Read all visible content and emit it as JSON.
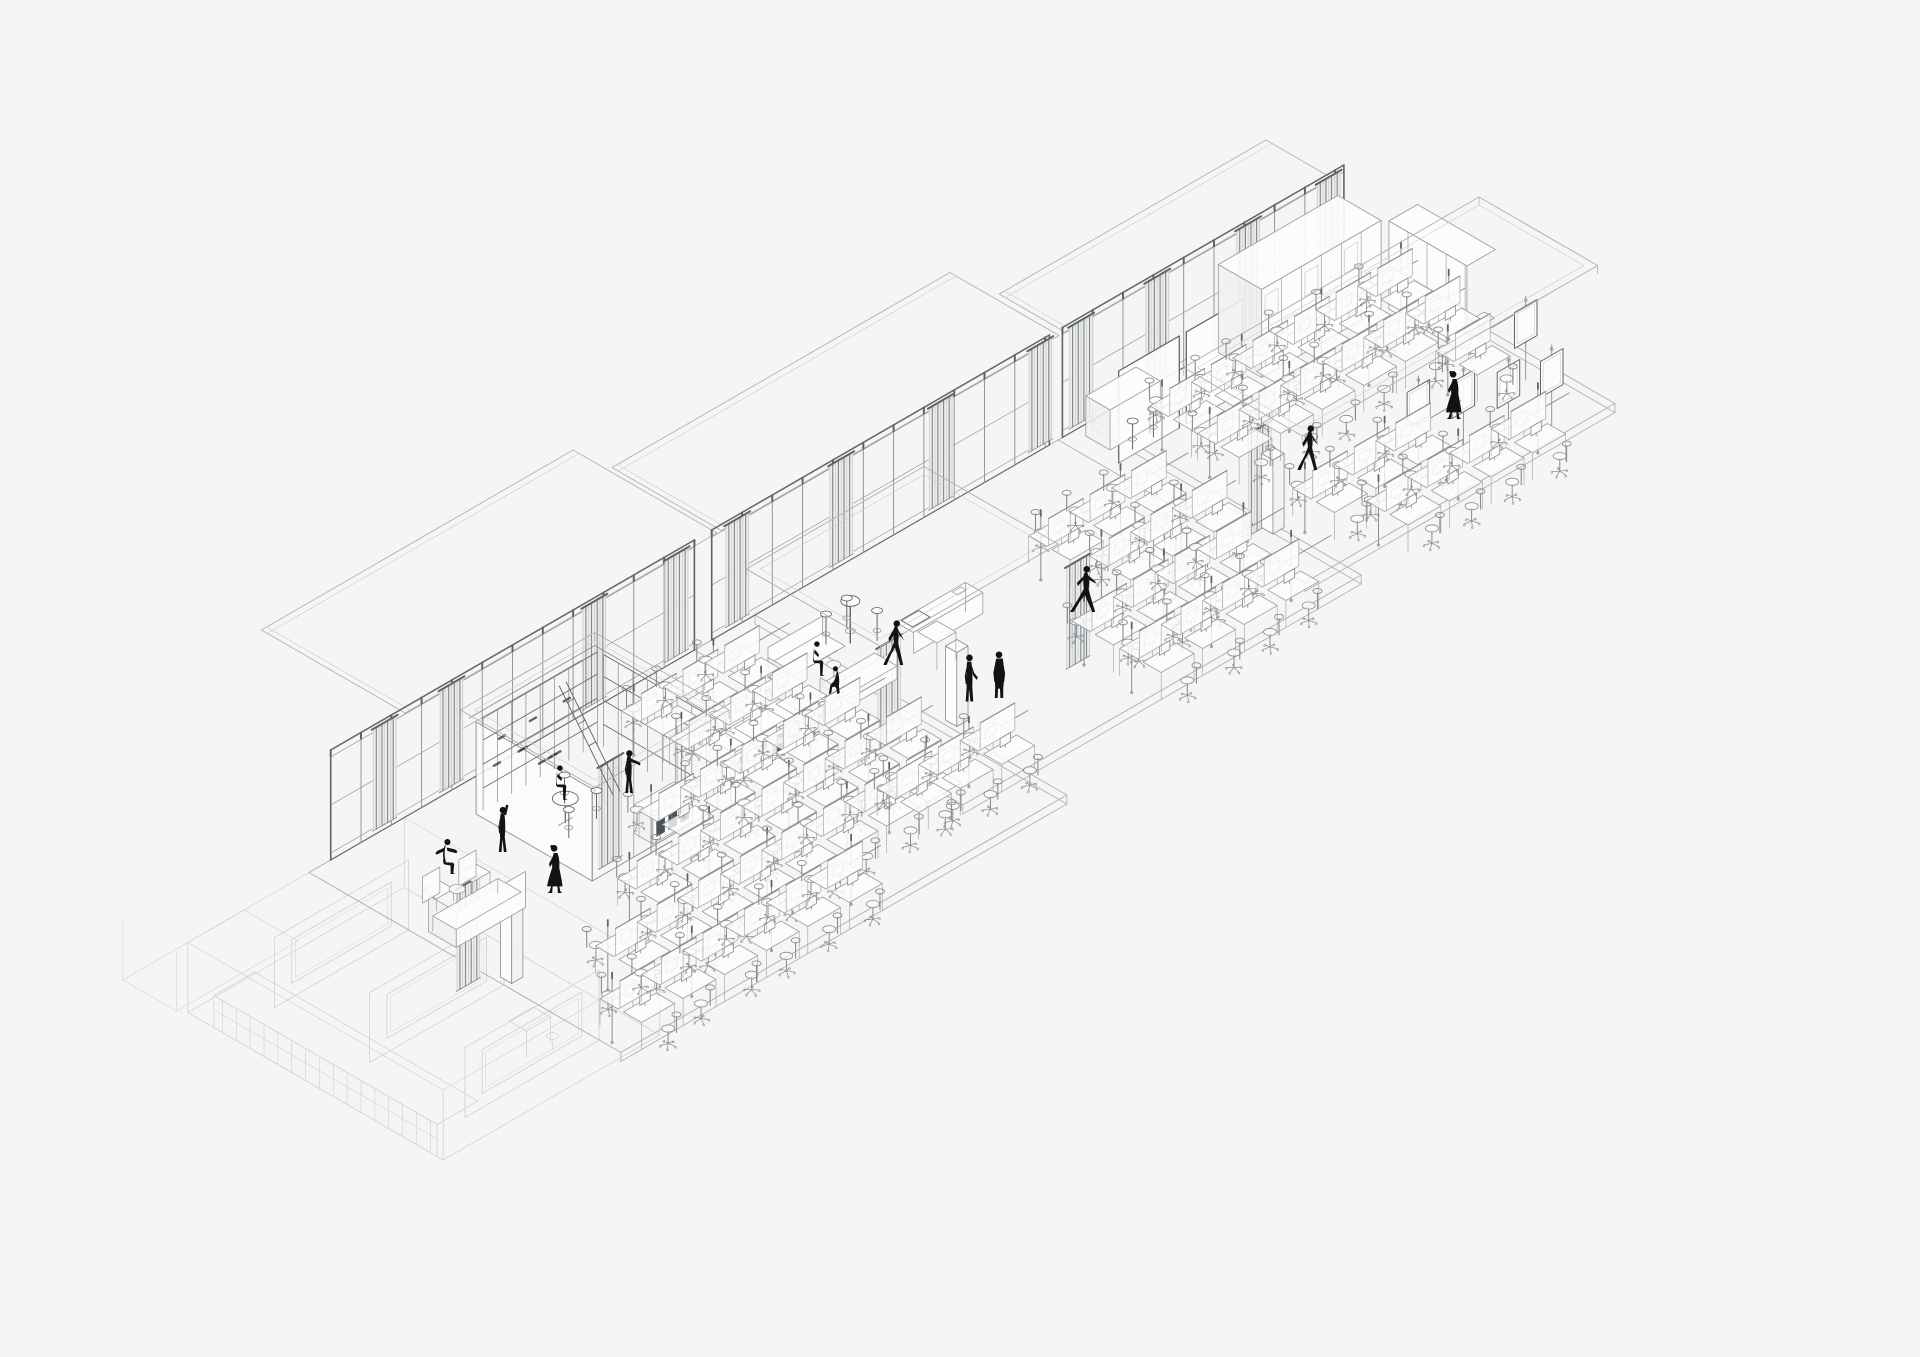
{
  "meta": {
    "drawing": "isometric-office-floor-axonometric",
    "canvas": {
      "width": 1920,
      "height": 1357
    },
    "background": "#f5f5f4"
  },
  "palette": {
    "ink": "#121316",
    "wall": "#5f6468",
    "mullion": "#888d91",
    "light": "#aeb3b6",
    "lighter": "#c7cbce",
    "furn": "#9aa0a4",
    "chair": "#868c90",
    "fill_white": "#fcfcfb",
    "fill_soft": "#f1f1f0",
    "slot_dark": "#3c4145",
    "curtain_dark": "#82888c",
    "curtain_light": "#c3c7ca",
    "curtain_bg": "#ebebea"
  },
  "iso": {
    "origin_x": 322,
    "origin_y": 865,
    "cos": 0.866,
    "sin": 0.5,
    "wall_height": 110
  },
  "floors": [
    {
      "u0": -15,
      "u1": 500,
      "v1": 360
    },
    {
      "u0": 430,
      "u1": 890,
      "v1": 310
    },
    {
      "u0": 850,
      "u1": 1208,
      "v1": 285
    }
  ],
  "walls": [
    {
      "u0": 10,
      "u1": 430,
      "curtains": [
        58,
        135,
        300,
        395
      ]
    },
    {
      "u0": 450,
      "u1": 840,
      "curtains": [
        465,
        585,
        700,
        815
      ]
    },
    {
      "u0": 855,
      "u1": 1180,
      "curtains": [
        862,
        950,
        1055,
        1148
      ]
    }
  ],
  "eaves": [
    {
      "u0": 90,
      "u1": 450,
      "vdepth": -160
    },
    {
      "u0": 455,
      "u1": 845,
      "vdepth": -120
    },
    {
      "u0": 852,
      "u1": 1160,
      "vdepth": -70
    }
  ],
  "roof_plates": [
    {
      "u0": 135,
      "u1": 290,
      "v0": 25,
      "v1": 180,
      "h": 100
    },
    {
      "u0": 435,
      "u1": 640,
      "v0": 55,
      "v1": 210,
      "h": 106
    },
    {
      "u0": 887,
      "u1": 1228,
      "v0": 108,
      "v1": 245,
      "h": 108
    }
  ],
  "columns": [
    {
      "u": -9,
      "v": 215
    },
    {
      "u": 505,
      "v": 215
    },
    {
      "u": 748,
      "v": 212
    },
    {
      "u": 880,
      "v": 205
    }
  ],
  "interior_curtains": [
    {
      "u": -54,
      "v": 210
    },
    {
      "u": 150,
      "v": 170
    },
    {
      "u": 430,
      "v": 212
    },
    {
      "u": 620,
      "v": 240
    },
    {
      "u": 858,
      "v": 212
    }
  ],
  "desk_rails": [
    {
      "v": 70,
      "u0": 290,
      "u1": 470
    },
    {
      "v": 125,
      "u0": 290,
      "u1": 470
    },
    {
      "v": 180,
      "u0": 200,
      "u1": 470
    },
    {
      "v": 235,
      "u0": 120,
      "u1": 470
    },
    {
      "v": 290,
      "u0": 40,
      "u1": 460
    },
    {
      "v": 345,
      "u0": -10,
      "u1": 300
    },
    {
      "v": 130,
      "u0": 700,
      "u1": 870
    },
    {
      "v": 185,
      "u0": 715,
      "u1": 870
    },
    {
      "v": 240,
      "u0": 640,
      "u1": 870
    },
    {
      "v": 295,
      "u0": 360,
      "u1": 520
    },
    {
      "v": 295,
      "u0": 640,
      "u1": 870
    },
    {
      "v": 70,
      "u0": 900,
      "u1": 1195
    },
    {
      "v": 125,
      "u0": 900,
      "u1": 1195
    },
    {
      "v": 235,
      "u0": 900,
      "u1": 1080
    },
    {
      "v": 290,
      "u0": 930,
      "u1": 1150
    },
    {
      "v": 180,
      "u0": 1120,
      "u1": 1195
    }
  ],
  "library": {
    "u0": 140,
    "u1": 285,
    "v0": 30,
    "v1": 172,
    "shelf_v": 38,
    "table": {
      "u": 183,
      "v": 98,
      "r": 15
    },
    "stools": [
      {
        "u": 202,
        "v": 78
      },
      {
        "u": 170,
        "v": 115
      },
      {
        "u": 205,
        "v": 112
      }
    ],
    "ladder_u": 240,
    "credenza": {
      "u0": 212,
      "u1": 258,
      "v0": 148,
      "v1": 170,
      "h": 28
    }
  },
  "sideboard": {
    "u0": 320,
    "u1": 400,
    "v0": 128,
    "v1": 156,
    "h": 30,
    "slots": 4
  },
  "lounge_a": {
    "sofa": {
      "u0": -5,
      "u1": 75,
      "v0": 128,
      "v1": 160,
      "h": 36
    },
    "armchairs": [
      {
        "u": 20,
        "v": 96
      },
      {
        "u": 58,
        "v": 100
      }
    ],
    "table": {
      "u": 40,
      "v": 116,
      "r": 9
    }
  },
  "lounge_b": {
    "sofas": [
      {
        "u0": 445,
        "u1": 508,
        "v0": 70,
        "v1": 96,
        "back": "far"
      },
      {
        "u0": 455,
        "u1": 518,
        "v0": 120,
        "v1": 146,
        "back": "near"
      }
    ],
    "table": {
      "u": 483,
      "v": 108,
      "r": 8
    }
  },
  "bar": {
    "u": 527,
    "v": 83,
    "stools": [
      {
        "u": 512,
        "v": 70
      },
      {
        "u": 540,
        "v": 66
      },
      {
        "u": 545,
        "v": 96
      }
    ]
  },
  "exec_desk": {
    "u0": 545,
    "u1": 625,
    "v0": 118,
    "v1": 138,
    "return_u0": 550,
    "return_u1": 572,
    "return_v1": 160,
    "board": {
      "u0": 548,
      "u1": 568,
      "v0": 121,
      "v1": 134
    }
  },
  "pods_c": [
    {
      "u0": 862,
      "u1": 932,
      "v": 58
    },
    {
      "u0": 940,
      "u1": 1005,
      "v": 58
    }
  ],
  "pod_counter": {
    "u0": 870,
    "u1": 928,
    "v0": 12,
    "v1": 40,
    "h": 40
  },
  "wardrobes": [
    {
      "u0": 1030,
      "u1": 1168,
      "v0": 5,
      "v1": 55,
      "h": 88,
      "axis": "u"
    },
    {
      "u0": 1172,
      "u1": 1205,
      "v0": 60,
      "v1": 150,
      "h": 88,
      "axis": "v"
    }
  ],
  "side_table_c": {
    "u": 1187,
    "v": 153
  },
  "mirror_boards": [
    {
      "u": 1038,
      "v": 228
    },
    {
      "u": 1074,
      "v": 244
    },
    {
      "u": 1110,
      "v": 260
    },
    {
      "u": 1146,
      "v": 274
    },
    {
      "u": 1180,
      "v": 210
    }
  ],
  "annex": {
    "u0": -225,
    "u1": 25,
    "v0": 70,
    "v1": 365,
    "wall_h": 70,
    "window_walls": [
      {
        "v": 115
      },
      {
        "v": 225
      },
      {
        "v": 335
      }
    ],
    "bench": {
      "u0": -225,
      "u1": -178,
      "v0": 100,
      "v1": 358,
      "h": 32
    },
    "desk": {
      "u": -60,
      "v": 300
    }
  },
  "faint_box": {
    "u0": -230,
    "u1": -90,
    "v0": 0,
    "v1": 62
  },
  "people": [
    {
      "pose": "sit_arms_out",
      "x": 447,
      "y": 874,
      "s": 0.45,
      "flip": false,
      "label": "seated-figure-gesturing"
    },
    {
      "pose": "reach_up",
      "x": 502,
      "y": 852,
      "s": 0.46,
      "flip": false,
      "label": "standing-figure-reaching-up"
    },
    {
      "pose": "dress_walk",
      "x": 556,
      "y": 893,
      "s": 0.47,
      "flip": false,
      "label": "walking-figure-long-dress"
    },
    {
      "pose": "sit_profile",
      "x": 557,
      "y": 800,
      "s": 0.42,
      "flip": false,
      "label": "figure-on-stool"
    },
    {
      "pose": "reach_fwd",
      "x": 628,
      "y": 793,
      "s": 0.45,
      "flip": false,
      "label": "standing-figure-at-shelf"
    },
    {
      "pose": "sit_profile",
      "x": 814,
      "y": 676,
      "s": 0.42,
      "flip": false,
      "label": "seated-figure-lounge"
    },
    {
      "pose": "sit_low",
      "x": 838,
      "y": 694,
      "s": 0.42,
      "flip": true,
      "label": "low-seated-figure"
    },
    {
      "pose": "walk",
      "x": 894,
      "y": 665,
      "s": 0.46,
      "flip": false,
      "label": "walking-figure"
    },
    {
      "pose": "stand",
      "x": 969,
      "y": 702,
      "s": 0.47,
      "flip": false,
      "label": "standing-figure"
    },
    {
      "pose": "stand_coat",
      "x": 999,
      "y": 698,
      "s": 0.47,
      "flip": true,
      "label": "standing-figure-coat"
    },
    {
      "pose": "walk_wide",
      "x": 1083,
      "y": 612,
      "s": 0.47,
      "flip": false,
      "label": "striding-figure"
    },
    {
      "pose": "walk",
      "x": 1308,
      "y": 470,
      "s": 0.46,
      "flip": false,
      "label": "walking-figure"
    },
    {
      "pose": "dress_walk",
      "x": 1455,
      "y": 419,
      "s": 0.47,
      "flip": false,
      "label": "walking-figure-long-dress"
    }
  ]
}
